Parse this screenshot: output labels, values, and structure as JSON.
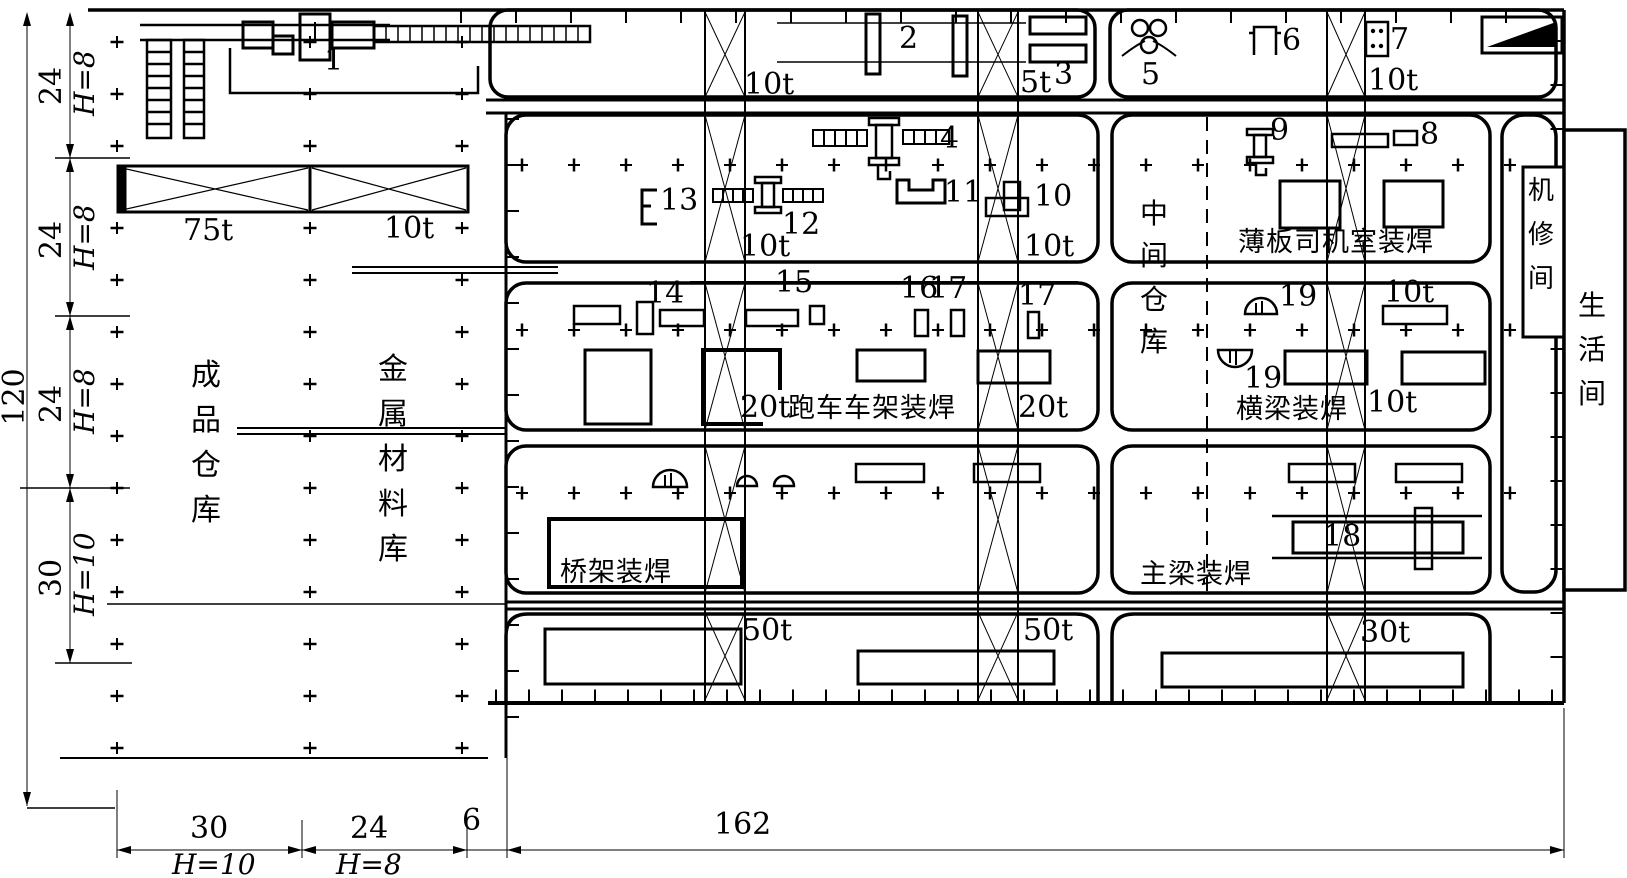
{
  "drawing": {
    "machines": {
      "m1": "1",
      "m2": "2",
      "m3": "3",
      "m4": "4",
      "m5": "5",
      "m6": "6",
      "m7": "7",
      "m8": "8",
      "m9": "9",
      "m10": "10",
      "m11": "11",
      "m12": "12",
      "m13": "13",
      "m14": "14",
      "m15": "15",
      "m16": "16",
      "m17": "17",
      "m18": "18",
      "m19": "19"
    },
    "capacities": {
      "t75": "75t",
      "t10": "10t",
      "t5": "5t",
      "t20": "20t",
      "t50": "50t",
      "t30": "30t"
    },
    "zones": {
      "finished_goods": [
        "成",
        "品",
        "仓",
        "库"
      ],
      "metal_materials": [
        "金",
        "属",
        "材",
        "料",
        "库"
      ],
      "intermediate_store": [
        "中",
        "间",
        "仓",
        "库"
      ],
      "cab_welding": "薄板司机室装焊",
      "trolley_frame_welding": "跑车车架装焊",
      "crossbeam_welding": "横梁装焊",
      "bridge_frame_welding": "桥架装焊",
      "main_girder_welding": "主梁装焊",
      "machine_repair": [
        "机",
        "修",
        "间"
      ],
      "living_quarters": [
        "生",
        "活",
        "间"
      ]
    },
    "dimensions": {
      "total_height": "120",
      "bay_24": "24",
      "bay_30": "30",
      "gap_6": "6",
      "total_width": "162",
      "height_8": "H=8",
      "height_10": "H=10"
    }
  }
}
